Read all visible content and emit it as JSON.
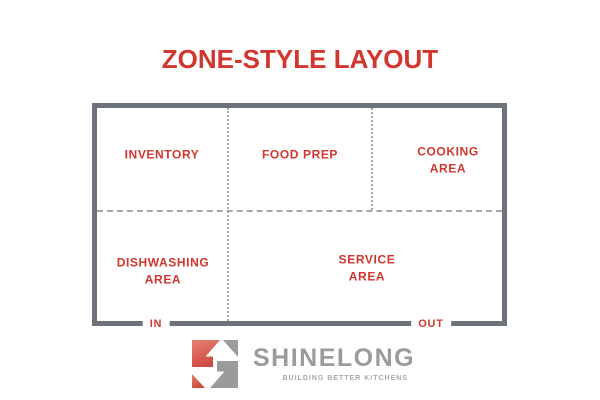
{
  "title": "ZONE-STYLE LAYOUT",
  "colors": {
    "accent_red": "#d2362e",
    "wall_gray": "#6e727a",
    "divider_gray": "#a3a7ac",
    "logo_gray": "#9b9b99",
    "logo_red": "#dd685c"
  },
  "floor_plan": {
    "zones": [
      {
        "name": "inventory",
        "label": "INVENTORY"
      },
      {
        "name": "food-prep",
        "label": "FOOD PREP"
      },
      {
        "name": "cooking-area",
        "label": "COOKING\nAREA"
      },
      {
        "name": "dishwashing-area",
        "label": "DISHWASHING\nAREA"
      },
      {
        "name": "service-area",
        "label": "SERVICE\nAREA"
      }
    ],
    "doors": {
      "in": "IN",
      "out": "OUT"
    }
  },
  "logo": {
    "wordmark": "SHINELONG",
    "tagline": "BUILDING BETTER KITCHENS"
  }
}
